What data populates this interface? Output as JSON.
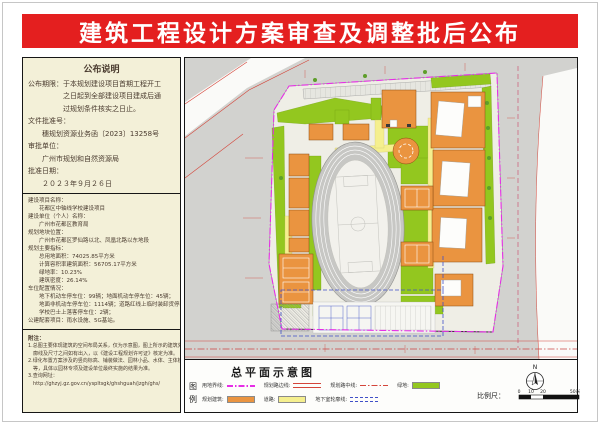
{
  "title": "建筑工程设计方案审查及调整批后公布",
  "info_panel": {
    "section1": {
      "heading": "公布说明",
      "lines": [
        "公布期限：于本规划建设项目首期工程开工",
        "　　　　　之日起到全部建设项目建成后通",
        "　　　　　过规划条件核实之日止。",
        "文件批准号：",
        "　　穗规划资源业务函〔2023〕13258号",
        "审批单位：",
        "　　广州市规划和自然资源局",
        "批准日期：",
        "　　２０２３年９月２６日"
      ]
    },
    "section2": {
      "lines": [
        "建设项目名称：",
        "　　花都区中轴线学校建设项目",
        "建设单位（个人）名称：",
        "　　广州市花都区教育局",
        "规划地块位置：",
        "　　广州市花都区罗仙路以北、凤凰北路以东地段",
        "规划主要指标：",
        "　　总用地面积：74025.85平方米",
        "　　计算容积率建筑面积：56705.17平方米",
        "　　绿地率：10.23%",
        "　　建筑密度：26.14%",
        "车位配置情况：",
        "　　地下机动车停车位：99辆；地面机动车停车位：45辆；",
        "　　地面非机动车停车位：1114辆；道路红线上临时装卸货停车位：10辆；",
        "　　学校巴士上落客停车位：2辆；",
        "公建配套项目：雨水设施、5G基站。"
      ]
    },
    "section3": {
      "heading": "附注：",
      "lines": [
        "1.总图主要体现建筑的空间布局关系，仅为示意图，图上所示的建筑外轮",
        "　廓线及尺寸之间如有出入，以《建设工程规划许可证》核定为准。",
        "2.绿化布置方案涉及的竖向标高、铺装做法、园林小品、水体、主体植物",
        "　等，具体以园林专项及建设单位最终实施的结果为准。",
        "3.查询网址：",
        "　http://ghzyj.gz.gov.cn/yspltsgk/ghshguah/jzgh/ghs/"
      ]
    }
  },
  "legend_panel": {
    "title": "总平面示意图",
    "legend_chars": {
      "c1": "图",
      "c2": "例"
    },
    "items": [
      {
        "label": "用地界线:"
      },
      {
        "label": "规划路边线:"
      },
      {
        "label": "规划路中线:"
      },
      {
        "label": "绿地:"
      },
      {
        "label": "规划建筑:"
      },
      {
        "label": "道路:"
      },
      {
        "label": "地下室轮廓线:"
      }
    ],
    "compass_label": "N",
    "scale": {
      "label": "比例尺：",
      "ticks": [
        "0",
        "10",
        "20",
        "50米"
      ]
    }
  },
  "colors": {
    "banner_red": "#e41f1f",
    "panel_cream": "#f3f0d8",
    "green": "#93c71f",
    "building_orange": "#ea9440",
    "road_yellow": "#f5ef8e",
    "boundary_magenta": "#e62ee6",
    "underground_blue": "#4050c8",
    "road_line_red": "#d4453a"
  }
}
